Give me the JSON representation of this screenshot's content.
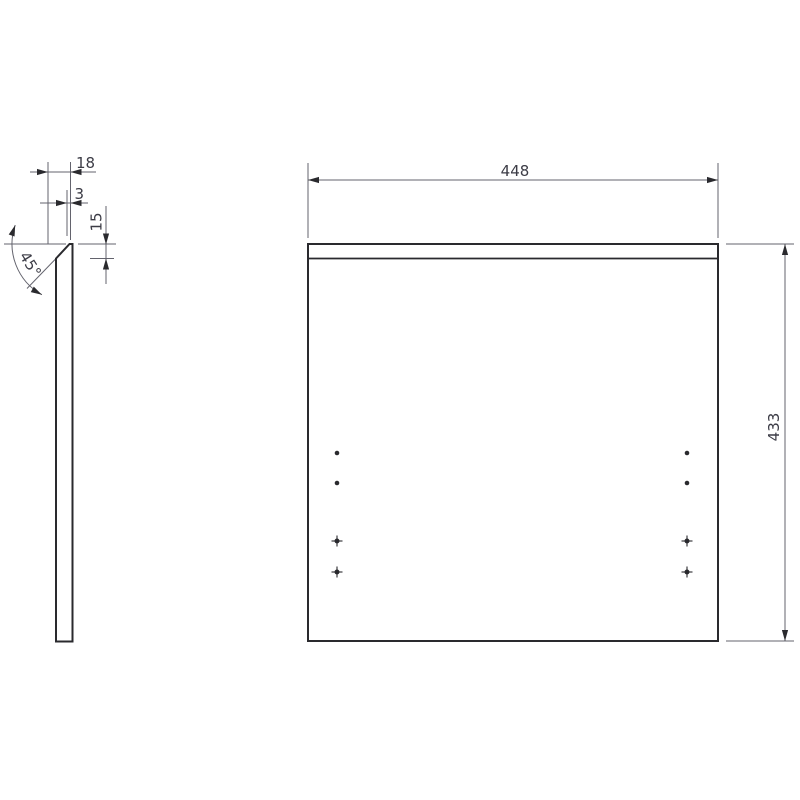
{
  "drawing": {
    "type": "technical-drawing",
    "views": {
      "side_view": {
        "name": "Side profile view",
        "thickness_label": "18",
        "top_flat_label": "3",
        "chamfer_height_label": "15",
        "chamfer_angle_label": "45°"
      },
      "front_view": {
        "name": "Front view",
        "width_label": "448",
        "height_label": "433",
        "hole_markers": {
          "dot_count": 4,
          "cross_count": 4
        }
      }
    },
    "colors": {
      "outline": "#2a2a2e",
      "dimension_line": "#63636d",
      "text": "#3c3c46",
      "background": "#ffffff"
    }
  }
}
